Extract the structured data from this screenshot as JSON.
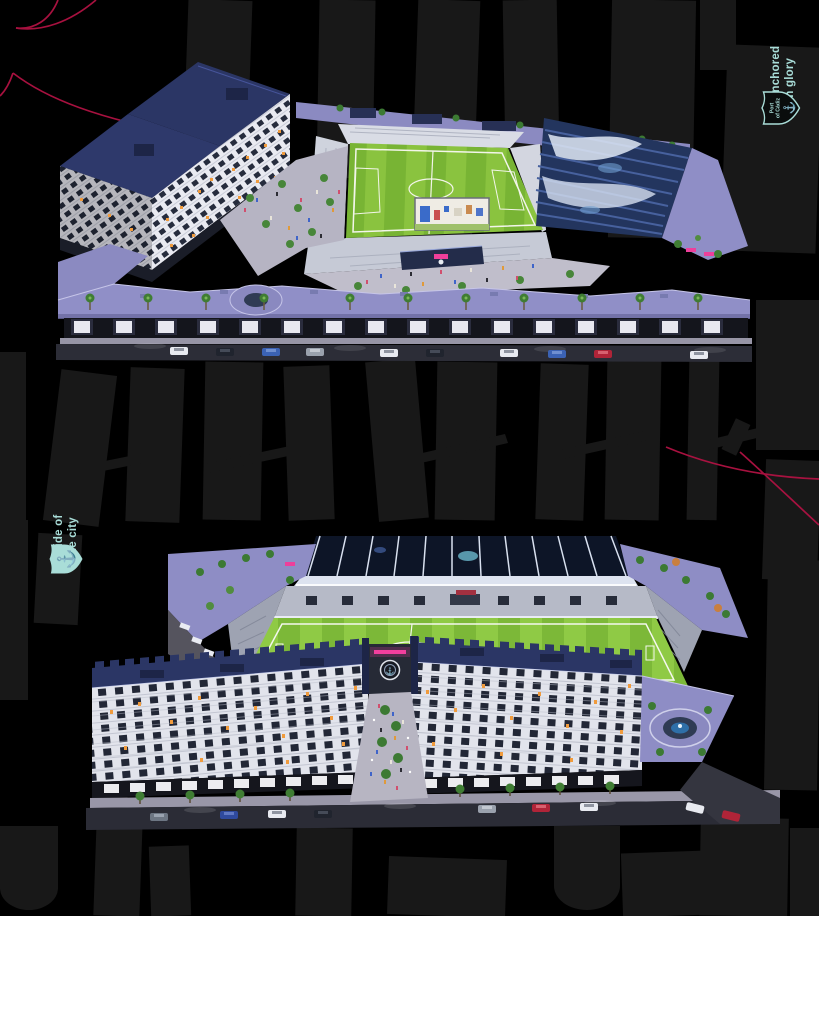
{
  "theme": {
    "page_background": "#ffffff",
    "hero_background": "#000000",
    "watermark_gray": "#181818",
    "accent_red": "#b01243",
    "accent_teal": "#a9ddd8",
    "pitch_green_light": "#8fca45",
    "pitch_green_dark": "#7cb838",
    "roof_lavender": "#908fc7",
    "roof_navy": "#2b3665",
    "tribune_blue": "#23355e",
    "neon_pink": "#ee3f9b",
    "window_light_orange": "#f09b3d"
  },
  "hero": {
    "tagline_top_right": {
      "line1": "Anchored",
      "line2": "in glory"
    },
    "badge_top_right": {
      "icon": "anchor-crest-outline",
      "label_line1": "Port",
      "label_line2": "of Cádiz",
      "anchor_glyph": "⚓"
    },
    "tagline_left": {
      "line1": "Pride of",
      "line2": "the city"
    },
    "badge_left": {
      "icon": "anchor-crest-solid",
      "anchor_glyph": "⚓"
    }
  }
}
